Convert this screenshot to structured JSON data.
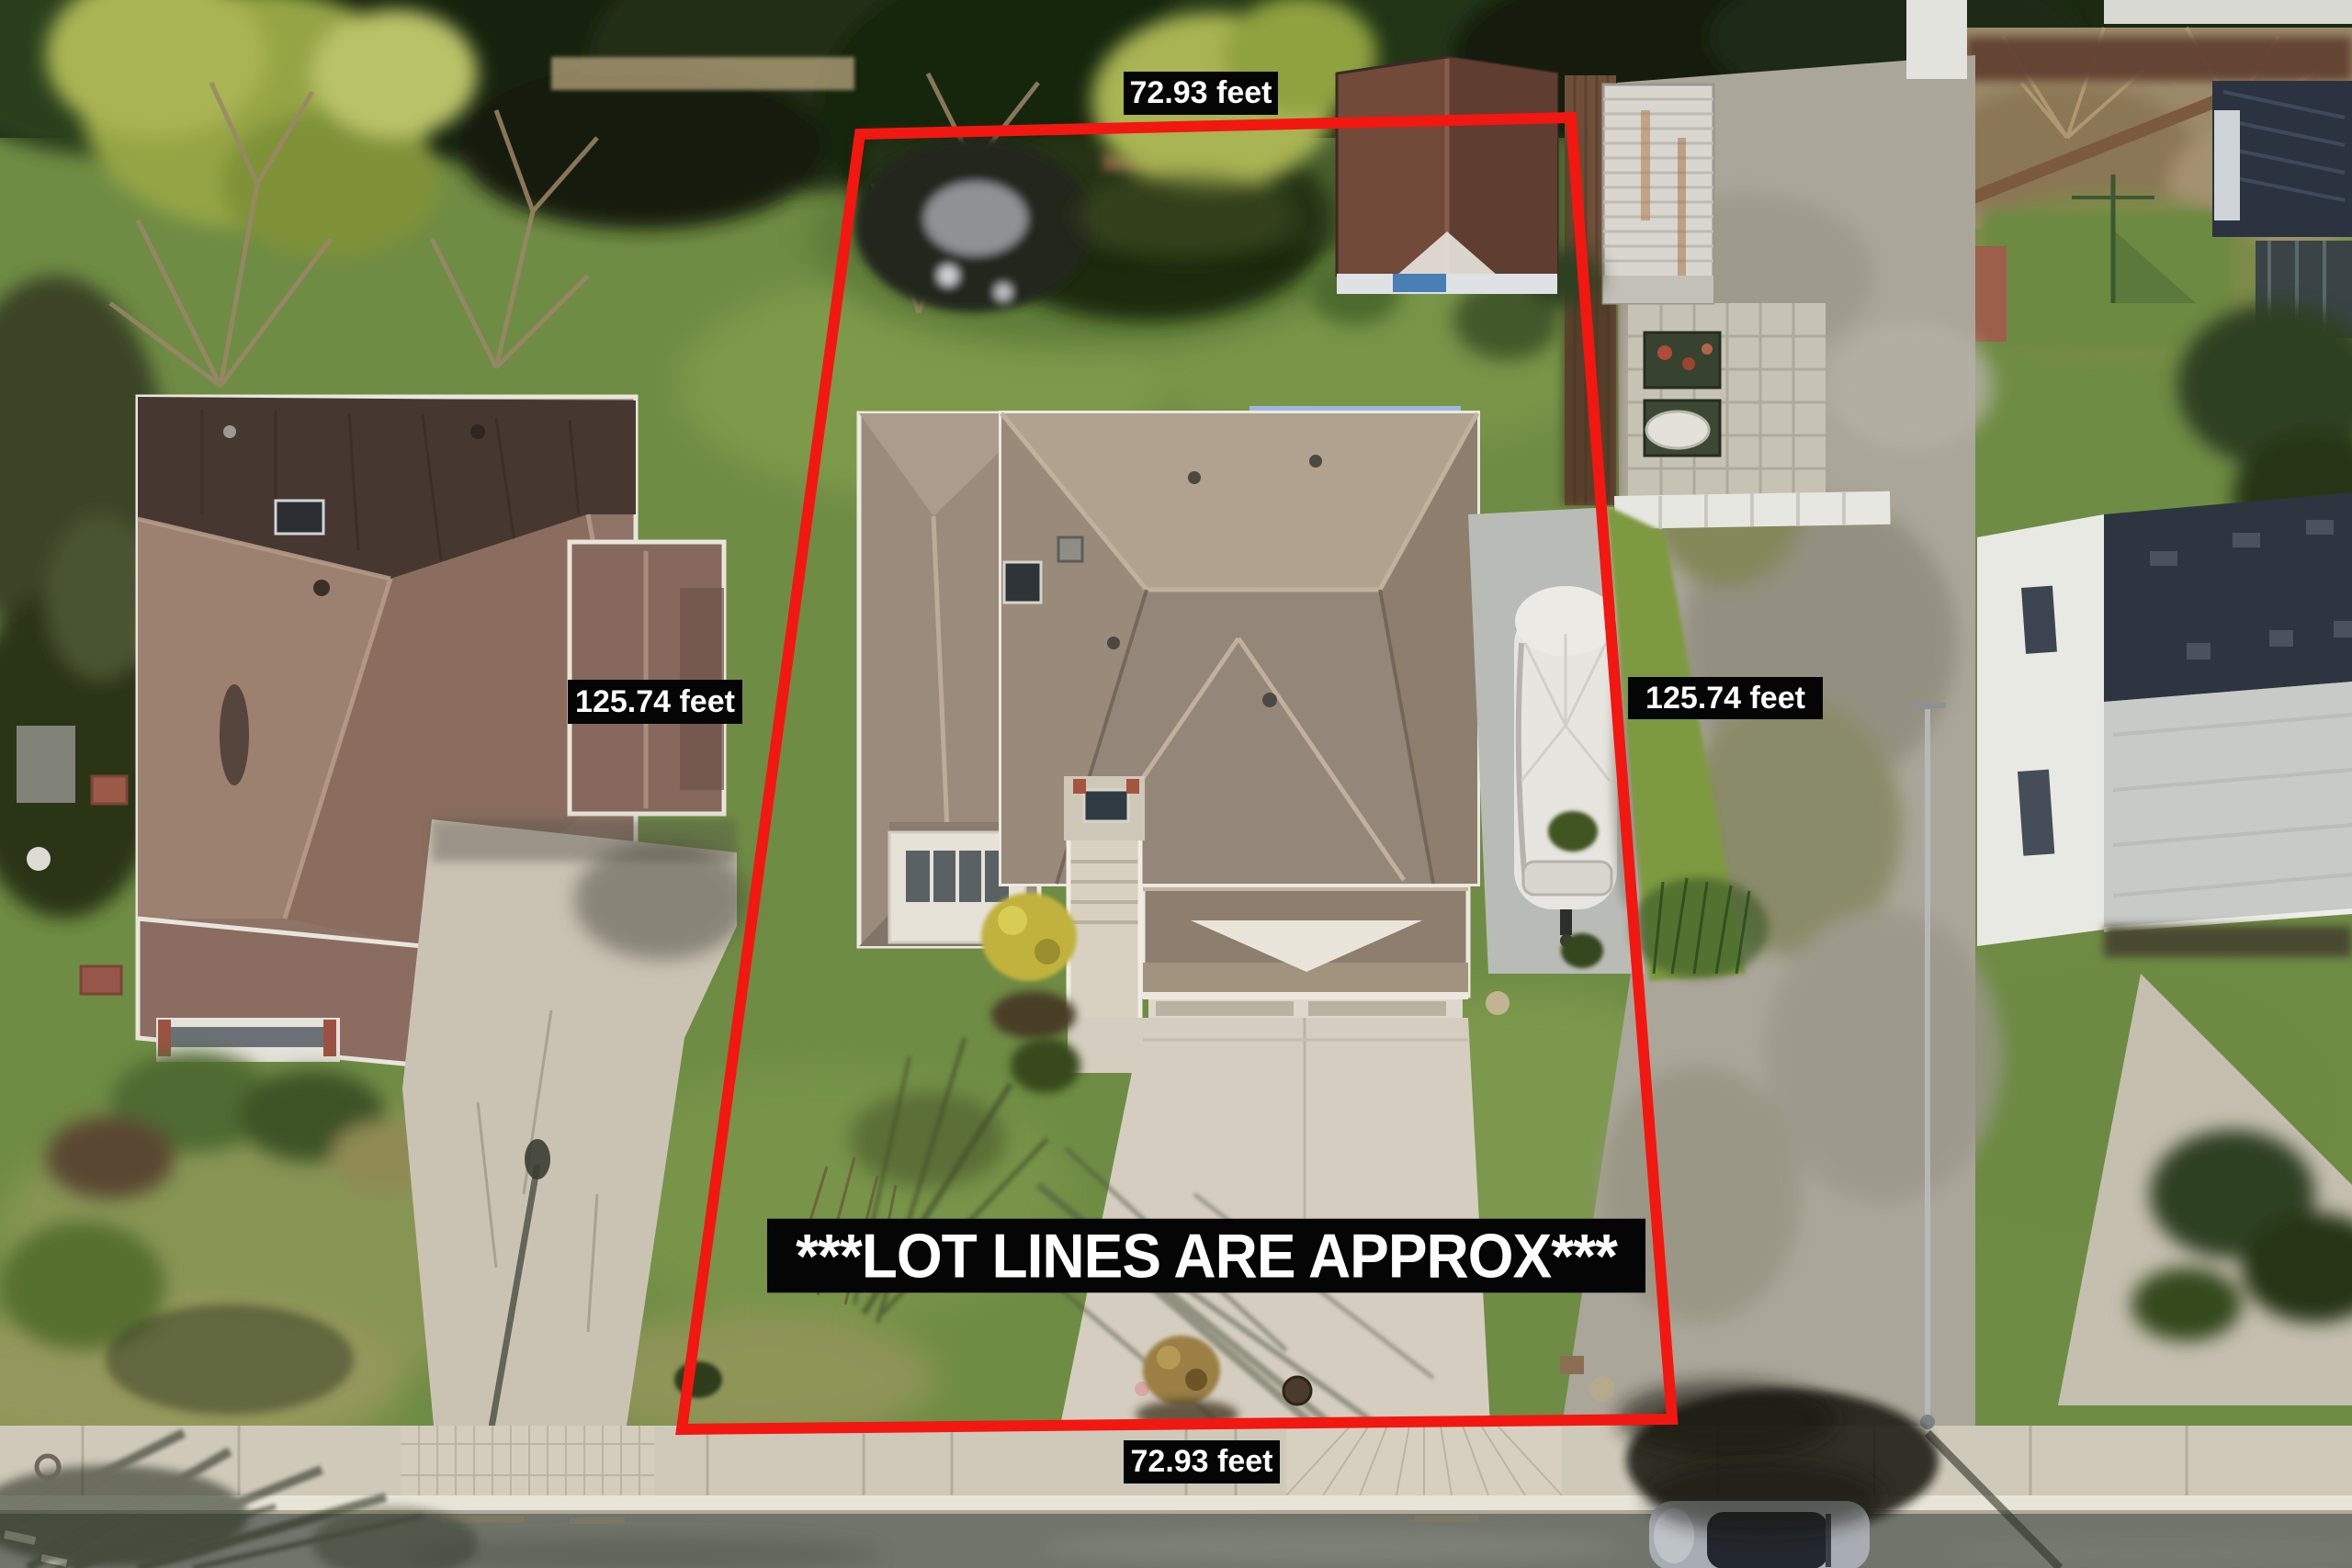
{
  "title": "Aerial drone photo of property with approximate lot lines",
  "annotations": {
    "top_dimension": "72.93 feet",
    "bottom_dimension": "72.93 feet",
    "left_dimension": "125.74 feet",
    "right_dimension": "125.74 feet",
    "disclaimer": "***LOT LINES ARE APPROX***"
  },
  "colors": {
    "lot_line": "#f21710",
    "label_bg": "#050505",
    "label_text": "#ffffff"
  },
  "scene": {
    "type": "aerial-drone-photo",
    "features": [
      "lot-boundary",
      "subject-house",
      "garage",
      "driveway",
      "entry-steps",
      "detached-shed",
      "covered-boat",
      "blue-canopy",
      "left-neighbor-house",
      "left-neighbor-driveway",
      "right-neighbor-building",
      "shipping-container",
      "gravel-driveway",
      "garden-planters",
      "hedge-row",
      "street",
      "sidewalk",
      "curb",
      "parked-car",
      "street-light",
      "tree-shadows"
    ]
  }
}
